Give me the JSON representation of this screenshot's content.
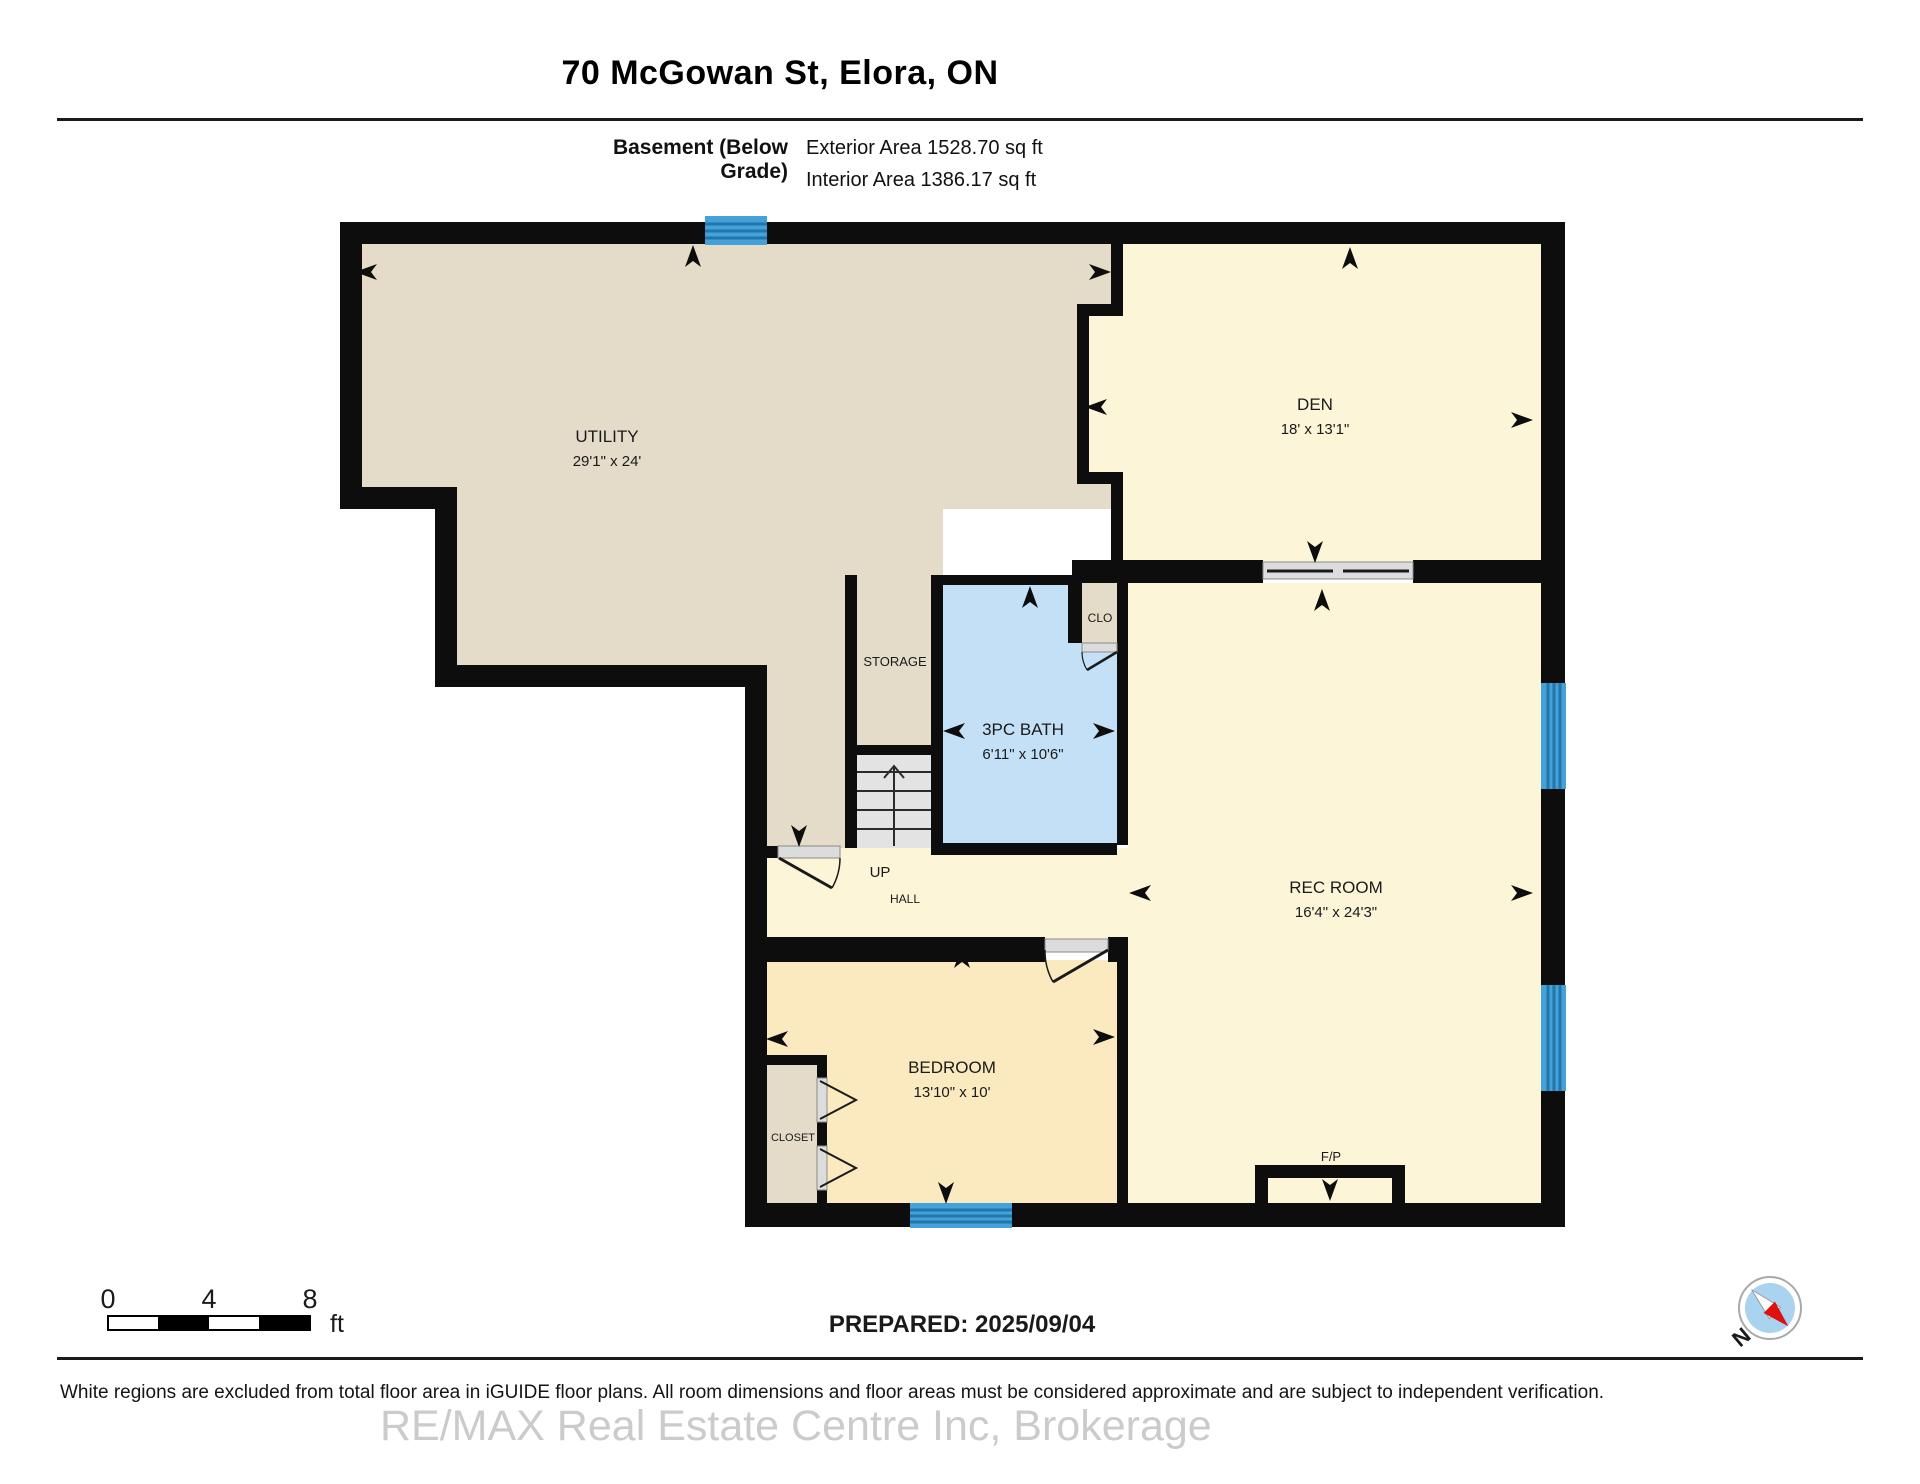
{
  "header": {
    "title": "70 McGowan St, Elora, ON",
    "floor_label": "Basement (Below Grade)",
    "exterior_area": "Exterior Area 1528.70 sq ft",
    "interior_area": "Interior Area 1386.17 sq ft"
  },
  "rooms": [
    {
      "id": "utility",
      "name": "UTILITY",
      "dims": "29'1\" x 24'"
    },
    {
      "id": "den",
      "name": "DEN",
      "dims": "18' x 13'1\""
    },
    {
      "id": "storage",
      "name": "STORAGE",
      "dims": ""
    },
    {
      "id": "bath",
      "name": "3PC BATH",
      "dims": "6'11\" x 10'6\""
    },
    {
      "id": "clo",
      "name": "CLO",
      "dims": ""
    },
    {
      "id": "rec-room",
      "name": "REC ROOM",
      "dims": "16'4\" x 24'3\""
    },
    {
      "id": "bedroom",
      "name": "BEDROOM",
      "dims": "13'10\" x 10'"
    },
    {
      "id": "closet",
      "name": "CLOSET",
      "dims": ""
    },
    {
      "id": "hall",
      "name": "HALL",
      "dims": ""
    },
    {
      "id": "stairs",
      "name": "UP",
      "dims": ""
    },
    {
      "id": "fireplace",
      "name": "F/P",
      "dims": ""
    }
  ],
  "scale_bar": {
    "t0": "0",
    "t4": "4",
    "t8": "8",
    "unit": "ft"
  },
  "prepared": "PREPARED: 2025/09/04",
  "compass_label": "N",
  "footer": {
    "disclaimer": "White regions are excluded from total floor area in iGUIDE floor plans. All room dimensions and floor areas must be considered approximate and are subject to independent verification.",
    "watermark": "RE/MAX Real Estate Centre Inc, Brokerage"
  },
  "colors": {
    "wall": "#0d0d0d",
    "room_tan": "#e4dbc8",
    "room_cream": "#fdf5d8",
    "room_gold": "#fbeac0",
    "room_bath": "#c3e0f7",
    "window_blue": "#45a1d8",
    "window_stripe": "#1f77ad",
    "stairs_gray": "#e3e3e3",
    "door_gray": "#dcdcdc",
    "compass_red": "#dd1111",
    "compass_blue": "#a9d3ef"
  }
}
